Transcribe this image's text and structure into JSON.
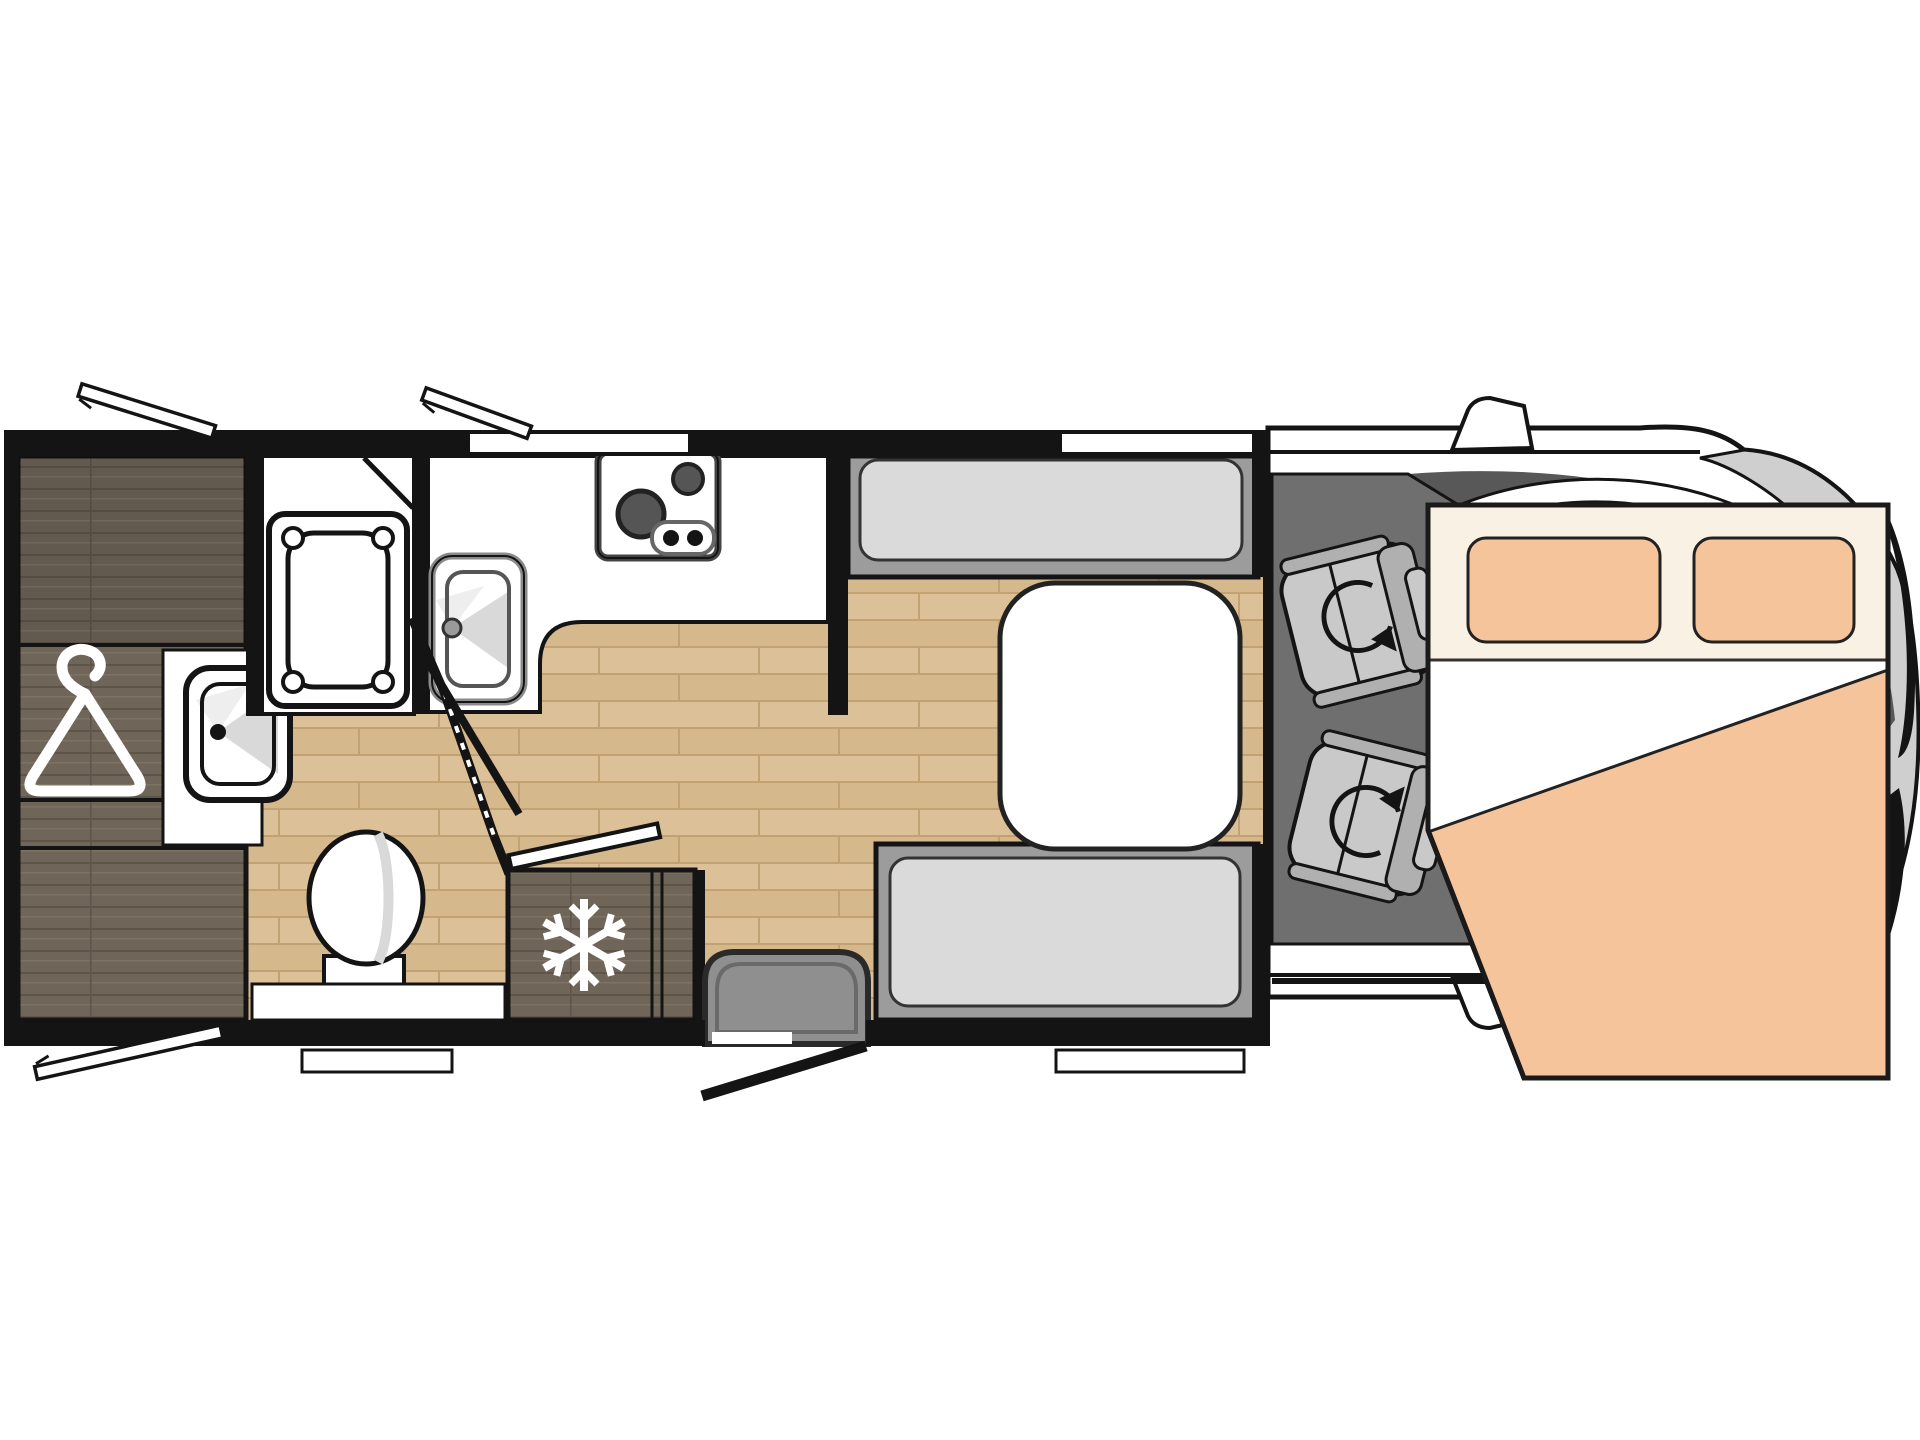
{
  "diagram": {
    "type": "motorhome-floor-plan",
    "orientation": "side-view-top-down, cab at right",
    "areas": [
      {
        "name": "wardrobe",
        "icon": "clothes-hanger-icon"
      },
      {
        "name": "shower-room",
        "fixtures": [
          "shower-tray",
          "shower-room-door"
        ]
      },
      {
        "name": "washroom",
        "fixtures": [
          "bathroom-sink",
          "toilet",
          "folding-door"
        ]
      },
      {
        "name": "kitchen",
        "fixtures": [
          "kitchen-counter",
          "kitchen-sink",
          "two-burner-stove",
          "refrigerator"
        ]
      },
      {
        "name": "dinette",
        "fixtures": [
          "front-bench-seat",
          "rear-bench-seat",
          "table"
        ]
      },
      {
        "name": "entry",
        "fixtures": [
          "entry-step",
          "entry-door"
        ]
      },
      {
        "name": "cab",
        "fixtures": [
          "driver-swivel-seat",
          "passenger-swivel-seat",
          "windshield",
          "side-mirrors"
        ]
      },
      {
        "name": "drop-down-bed",
        "fixtures": [
          "pillow-left",
          "pillow-right",
          "duvet"
        ]
      }
    ],
    "icons": [
      "clothes-hanger-icon",
      "snowflake-icon",
      "swivel-arrow-icon",
      "awning-window-icon"
    ]
  },
  "palette": {
    "line": "#141414",
    "floor_base": "#dcc198",
    "floor_alt": "#d5b88c",
    "floor_line": "#c2a273",
    "dark_wood": "#6f6559",
    "dark_wood_line": "#5e554a",
    "dark_wood_hi": "#7d7365",
    "bench_frame": "#9c9c9c",
    "bench_cushion": "#dadada",
    "cab_floor": "#6f6f6f",
    "seat_base": "#c9c9c9",
    "seat_back": "#b0b0b0",
    "bed_panel": "#f9f1e3",
    "bed_peach": "#f5c49b",
    "step_gray": "#8f8f8f",
    "body_silver": "#cfcfcf",
    "windshield": "#585858",
    "white": "#ffffff"
  }
}
